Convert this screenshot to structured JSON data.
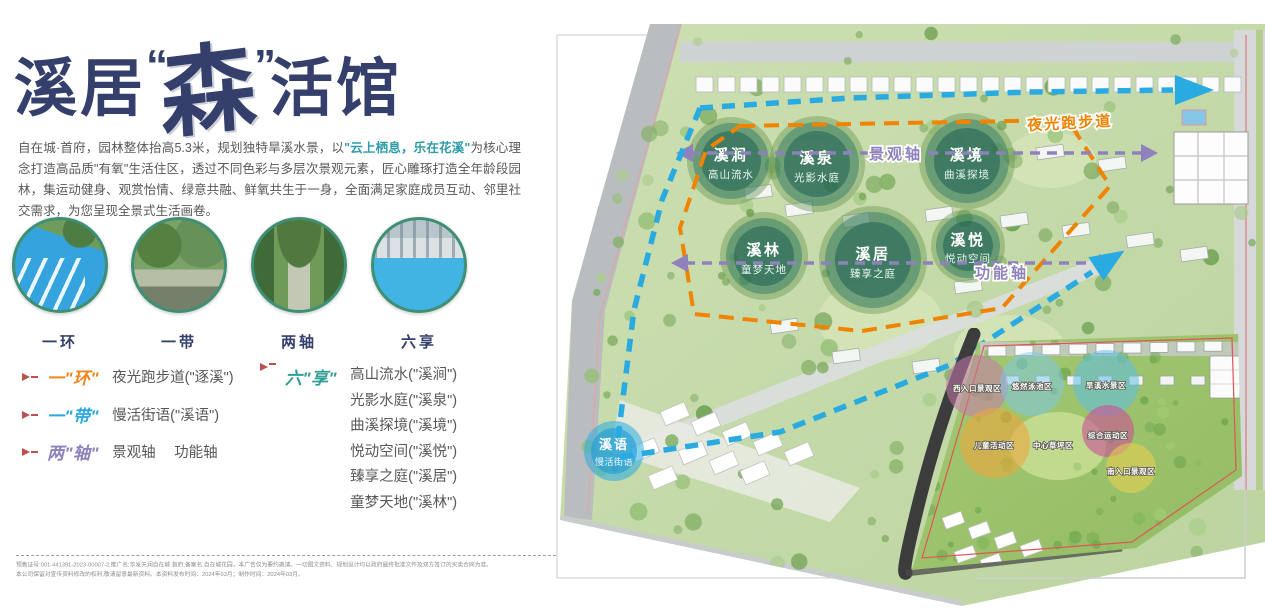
{
  "title": {
    "prefix": "溪居",
    "quote_open": "“",
    "emphasis": "森",
    "quote_close": "”",
    "suffix": "活馆"
  },
  "intro": {
    "text_before": "自在城·首府，园林整体抬高5.3米，规划独特旱溪水景，以",
    "highlight": "\"云上栖息，乐在花溪\"",
    "text_after": "为核心理念打造高品质\"有氧\"生活住区，透过不同色彩与多层次景观元素，匠心雕琢打造全年龄段园林，集运动健身、观赏怡情、绿意共融、鲜氧共生于一身，全面满足家庭成员互动、邻里社交需求，为您呈现全景式生活画卷。"
  },
  "features": [
    {
      "label": "一环"
    },
    {
      "label": "一带"
    },
    {
      "label": "两轴"
    },
    {
      "label": "六享"
    }
  ],
  "legend": {
    "items": [
      {
        "term": "一\"环\"",
        "color": "#f08519",
        "desc": "夜光跑步道(\"逐溪\")"
      },
      {
        "term": "一\"带\"",
        "color": "#2ba7e0",
        "desc": "慢活街语(\"溪语\")"
      },
      {
        "term": "两\"轴\"",
        "color": "#8f82bc",
        "desc": "景观轴　 功能轴"
      }
    ],
    "six": {
      "term": "六\"享\"",
      "color": "#2f9e96",
      "items": [
        "高山流水(\"溪涧\")",
        "光影水庭(\"溪泉\")",
        "曲溪探境(\"溪境\")",
        "悦动空间(\"溪悦\")",
        "臻享之庭(\"溪居\")",
        "童梦天地(\"溪林\")"
      ]
    }
  },
  "map": {
    "zones": [
      {
        "name": "溪涧",
        "sub": "高山流水"
      },
      {
        "name": "溪泉",
        "sub": "光影水庭"
      },
      {
        "name": "溪境",
        "sub": "曲溪探境"
      },
      {
        "name": "溪林",
        "sub": "童梦天地"
      },
      {
        "name": "溪居",
        "sub": "臻享之庭"
      },
      {
        "name": "溪悦",
        "sub": "悦动空间"
      }
    ],
    "street": {
      "name": "溪语",
      "sub": "慢活街语"
    },
    "labels": {
      "running_track": "夜光跑步道",
      "landscape_axis": "景观轴",
      "function_axis": "功能轴"
    },
    "colors": {
      "running_track": "#f08300",
      "axis": "#8f82bc",
      "street_route": "#29abe2",
      "zone_fill": "#1d6e62",
      "street_zone_fill": "#29abe2"
    }
  },
  "inset": {
    "areas": [
      "西入口景观区",
      "悠然泳池区",
      "旱溪水景区",
      "儿童活动区",
      "中心草坪区",
      "综合运动区",
      "南入口景观区"
    ],
    "area_colors": [
      "#c678ab",
      "#7cc8ea",
      "#5fbde6",
      "#efa63e",
      "#c0d98a",
      "#cc4f96",
      "#ecd24e"
    ]
  },
  "footer": {
    "line1": "预售证号:001-441391-2023-00007-2;推广名:华发天润自在城·首府;备案名:自在城花园，本广告仅为要约邀请。一切图文资料、规划设计均以政府最终批准文件及双方签订的买卖合同为准。",
    "line2": "本公司保留对宣传资料修改的权利,敬请留意最新资料。本资料发布时间：2024年03月；制作时间：2024年03月。"
  }
}
